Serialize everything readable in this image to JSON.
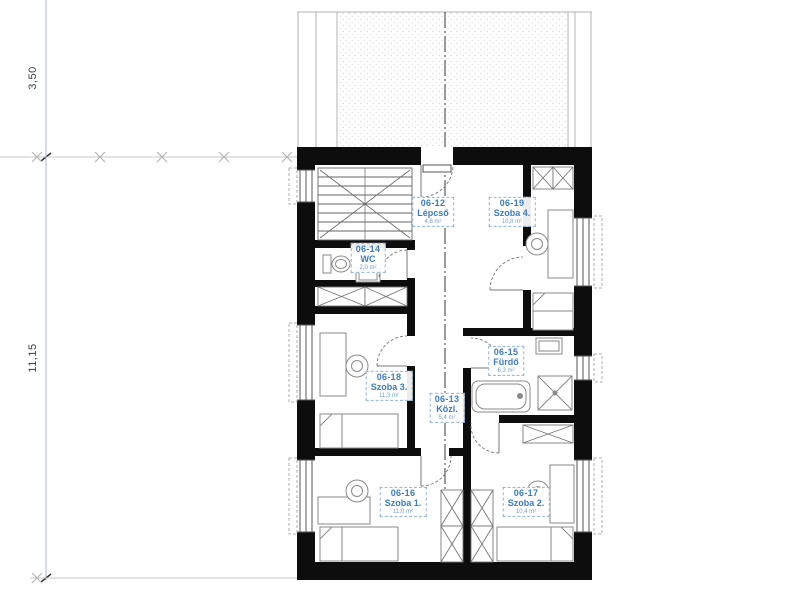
{
  "dimensions": {
    "segment_top": "3,50",
    "segment_main": "11,15"
  },
  "rooms": [
    {
      "id": "06-12",
      "name": "Lépcső",
      "area": "4,8 m²"
    },
    {
      "id": "06-13",
      "name": "Közl.",
      "area": "5,4 m²"
    },
    {
      "id": "06-14",
      "name": "WC",
      "area": "2,0 m²"
    },
    {
      "id": "06-15",
      "name": "Fürdő",
      "area": "6,3 m²"
    },
    {
      "id": "06-16",
      "name": "Szoba 1.",
      "area": "11,0 m²"
    },
    {
      "id": "06-17",
      "name": "Szoba 2.",
      "area": "10,4 m²"
    },
    {
      "id": "06-18",
      "name": "Szoba 3.",
      "area": "11,3 m²"
    },
    {
      "id": "06-19",
      "name": "Szoba 4.",
      "area": "10,8 m²"
    }
  ],
  "colors": {
    "room_label_blue": "#3c7cc0",
    "wall_black": "#0d0d0d",
    "furniture_gray": "#8a8a8a",
    "dimension_gray": "#c9c9c9",
    "axis_guide_blue": "#a6b8d8",
    "roof_stipple": "#d7d7d7"
  }
}
